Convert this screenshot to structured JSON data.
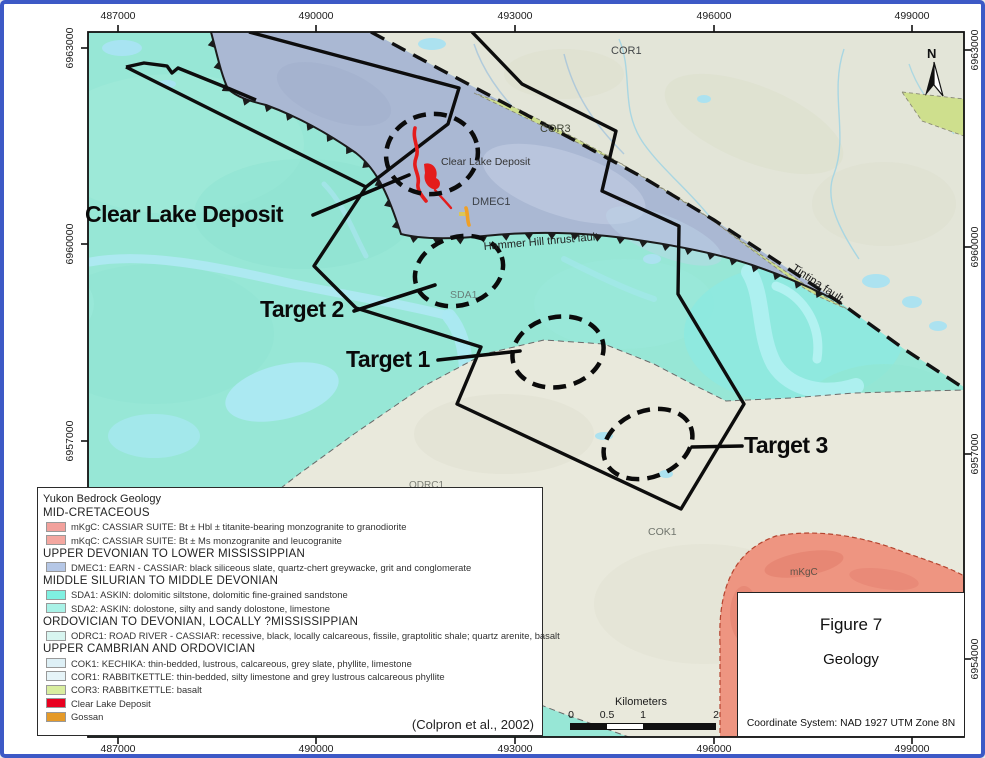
{
  "figure": {
    "number": "Figure 7",
    "title": "Geology",
    "coordinate_system": "Coordinate System: NAD 1927 UTM Zone 8N"
  },
  "source": "(Colpron et al., 2002)",
  "north_label": "N",
  "scalebar": {
    "unit_label": "Kilometers",
    "ticks": [
      "0",
      "0.5",
      "1",
      "2"
    ]
  },
  "axes": {
    "top": [
      "487000",
      "490000",
      "493000",
      "496000",
      "499000"
    ],
    "bottom": [
      "487000",
      "490000",
      "493000",
      "496000",
      "499000"
    ],
    "left": [
      "6963000",
      "6960000",
      "6957000",
      "6954000"
    ],
    "right": [
      "6963000",
      "6960000",
      "6957000",
      "6954000"
    ]
  },
  "map_labels": {
    "cor1": "COR1",
    "cor3": "COR3",
    "dmec1": "DMEC1",
    "clear_lake_deposit": "Clear Lake Deposit",
    "sda1": "SDA1",
    "odrc1": "ODRC1",
    "cok1": "COK1",
    "mkgc": "mKgC",
    "hammer_hill_fault": "Hammer Hill thrust fault",
    "tintina_fault": "Tintina fault"
  },
  "annotations": {
    "clear_lake": "Clear Lake Deposit",
    "target_1": "Target 1",
    "target_2": "Target 2",
    "target_3": "Target 3"
  },
  "legend": {
    "title": "Yukon Bedrock Geology",
    "rows": [
      {
        "type": "header",
        "label": "MID-CRETACEOUS"
      },
      {
        "type": "item",
        "label": "mKgC: CASSIAR SUITE: Bt ± Hbl ± titanite-bearing monzogranite to granodiorite",
        "color": "#F2A19C"
      },
      {
        "type": "item",
        "label": "mKqC: CASSIAR SUITE: Bt ± Ms monzogranite and leucogranite",
        "color": "#F4A7A0"
      },
      {
        "type": "header",
        "label": "UPPER DEVONIAN TO LOWER MISSISSIPPIAN"
      },
      {
        "type": "item",
        "label": "DMEC1: EARN - CASSIAR: black siliceous slate, quartz-chert greywacke, grit and conglomerate",
        "color": "#B5C7E6"
      },
      {
        "type": "header",
        "label": "MIDDLE SILURIAN TO MIDDLE DEVONIAN"
      },
      {
        "type": "item",
        "label": "SDA1: ASKIN: dolomitic siltstone, dolomitic fine-grained sandstone",
        "color": "#7FF0E1"
      },
      {
        "type": "item",
        "label": "SDA2: ASKIN: dolostone, silty and sandy dolostone, limestone",
        "color": "#A9F2E7"
      },
      {
        "type": "header",
        "label": "ORDOVICIAN TO DEVONIAN, LOCALLY ?MISSISSIPPIAN"
      },
      {
        "type": "item",
        "label": "ODRC1: ROAD RIVER - CASSIAR: recessive, black, locally calcareous, fissile, graptolitic shale; quartz arenite, basalt",
        "color": "#D8F5F0"
      },
      {
        "type": "header",
        "label": "UPPER CAMBRIAN AND ORDOVICIAN"
      },
      {
        "type": "item",
        "label": "COK1: KECHIKA: thin-bedded, lustrous, calcareous, grey slate, phyllite, limestone",
        "color": "#DEF0F6"
      },
      {
        "type": "item",
        "label": "COR1: RABBITKETTLE: thin-bedded, silty limestone and grey lustrous calcareous phyllite",
        "color": "#E6F4F8"
      },
      {
        "type": "item",
        "label": "COR3: RABBITKETTLE: basalt",
        "color": "#D9EE9F"
      },
      {
        "type": "item",
        "label": "Clear Lake Deposit",
        "color": "#E8001F"
      },
      {
        "type": "item",
        "label": "Gossan",
        "color": "#E59A28"
      }
    ]
  },
  "colors": {
    "border_blue": "#3D59C6",
    "cyan_sda": "#97E7D6",
    "blue_dmec1": "#AAB8D3",
    "pale_cor1": "#E3E5D8",
    "pale_odrc1": "#E9E9DC",
    "green_cor3": "#CEDF8D",
    "salmon_mkgc": "#EE9581",
    "deposit_red": "#E41C1C",
    "gossan_orange": "#EFA028",
    "water": "#AEE9F2"
  }
}
